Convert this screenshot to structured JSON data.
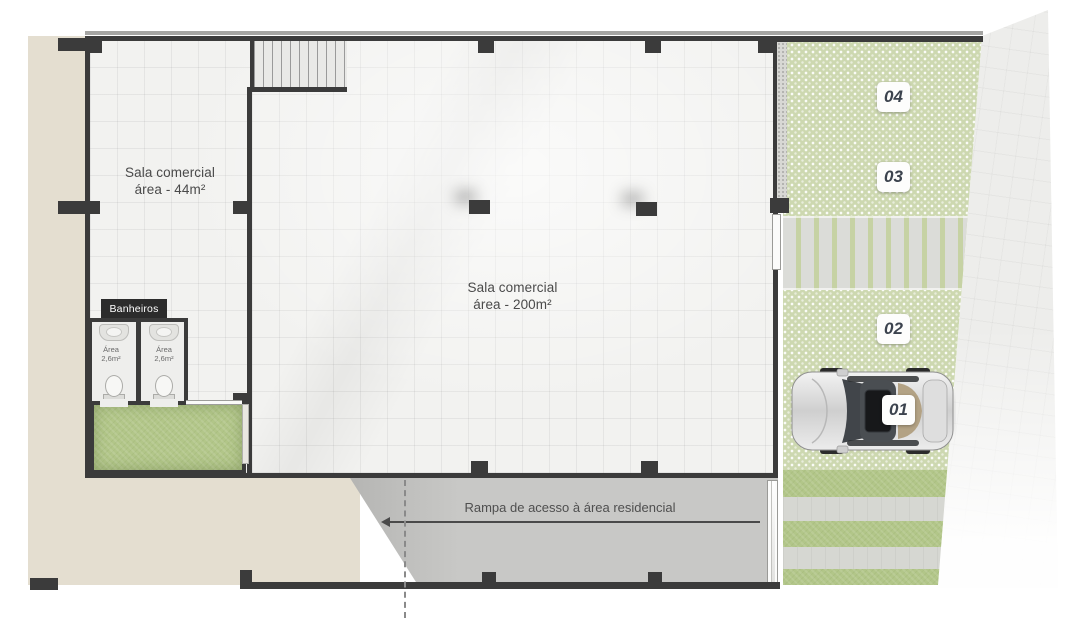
{
  "title": "Planta baixa - pavimento térreo comercial",
  "colors": {
    "wall": "#3b3b3b",
    "beige": "#e4ded0",
    "floor": "#f2f2f0",
    "grass": "#b2c689",
    "paver-green": "#cdd8b0",
    "paver-gray": "#d6d7d2",
    "walkway-paver": "#dbdcd8",
    "ramp": "#c8c8c6",
    "sidewalk": "#ededeb",
    "badge-text": "#3c434e",
    "label": "#4a4a4a"
  },
  "rooms": {
    "left": {
      "name_line": "Sala comercial",
      "area_line": "área - 44m²"
    },
    "main": {
      "name_line": "Sala comercial",
      "area_line": "área - 200m²"
    }
  },
  "bathrooms": {
    "title": "Banheiros",
    "stalls": [
      {
        "line1": "Área",
        "line2": "2,6m²"
      },
      {
        "line1": "Área",
        "line2": "2,6m²"
      }
    ]
  },
  "ramp": {
    "label": "Rampa de acesso à área residencial"
  },
  "parking": {
    "spaces": [
      {
        "number": "04"
      },
      {
        "number": "03"
      },
      {
        "number": "02"
      },
      {
        "number": "01"
      }
    ]
  }
}
